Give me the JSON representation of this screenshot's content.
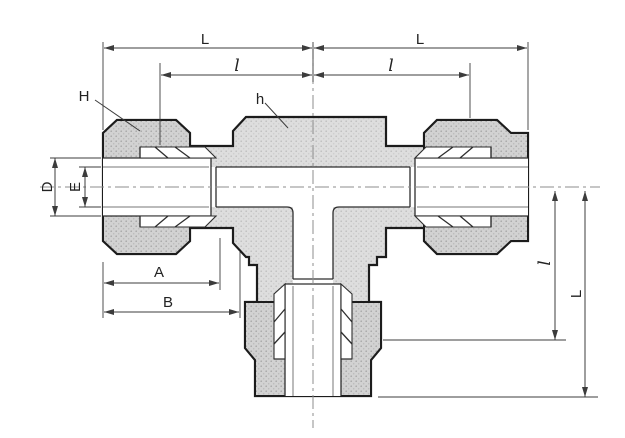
{
  "drawing": {
    "type": "technical-dimension-drawing",
    "subject": "union-tee-compression-fitting",
    "labels": {
      "L_top_left": "L",
      "L_top_right": "L",
      "l_top_left": "l",
      "l_top_right": "l",
      "H_callout": "H",
      "h_callout": "h",
      "D_dim": "D",
      "E_dim": "E",
      "A_dim": "A",
      "B_dim": "B",
      "l_right_vertical": "l",
      "L_right_vertical": "L"
    },
    "colors": {
      "outline": "#1c1c1c",
      "inner": "#2e2e2e",
      "dim": "#3c3c3c",
      "centerline": "#8c8c8c",
      "metal": "#dedede",
      "metal_dot": "#bdbdbd",
      "nut": "#d2d2d2",
      "nut_dot": "#a6a6a6",
      "background": "#ffffff"
    }
  }
}
